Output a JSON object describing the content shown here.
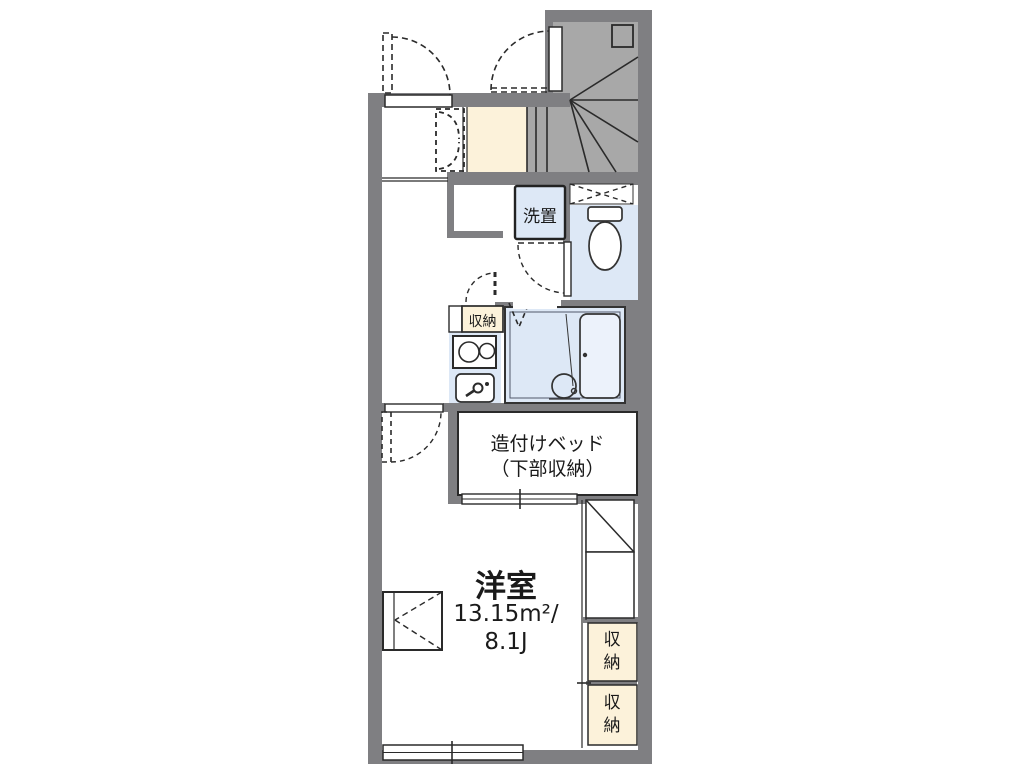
{
  "plan": {
    "labels": {
      "washer": "洗置",
      "kitchen_storage": "収納",
      "bed_line1": "造付けベッド",
      "bed_line2": "（下部収納）",
      "room_name": "洋室",
      "room_area": "13.15m²/",
      "room_size": "8.1J",
      "storage_upper": "収納",
      "storage_lower": "収納"
    },
    "colors": {
      "wall_gray": "#7f7f82",
      "stair_gray": "#a8a8a8",
      "entry_cream": "#fcf2da",
      "wet_area_blue": "#dde8f6",
      "line_dark": "#2a2a2a",
      "background": "#ffffff"
    }
  }
}
